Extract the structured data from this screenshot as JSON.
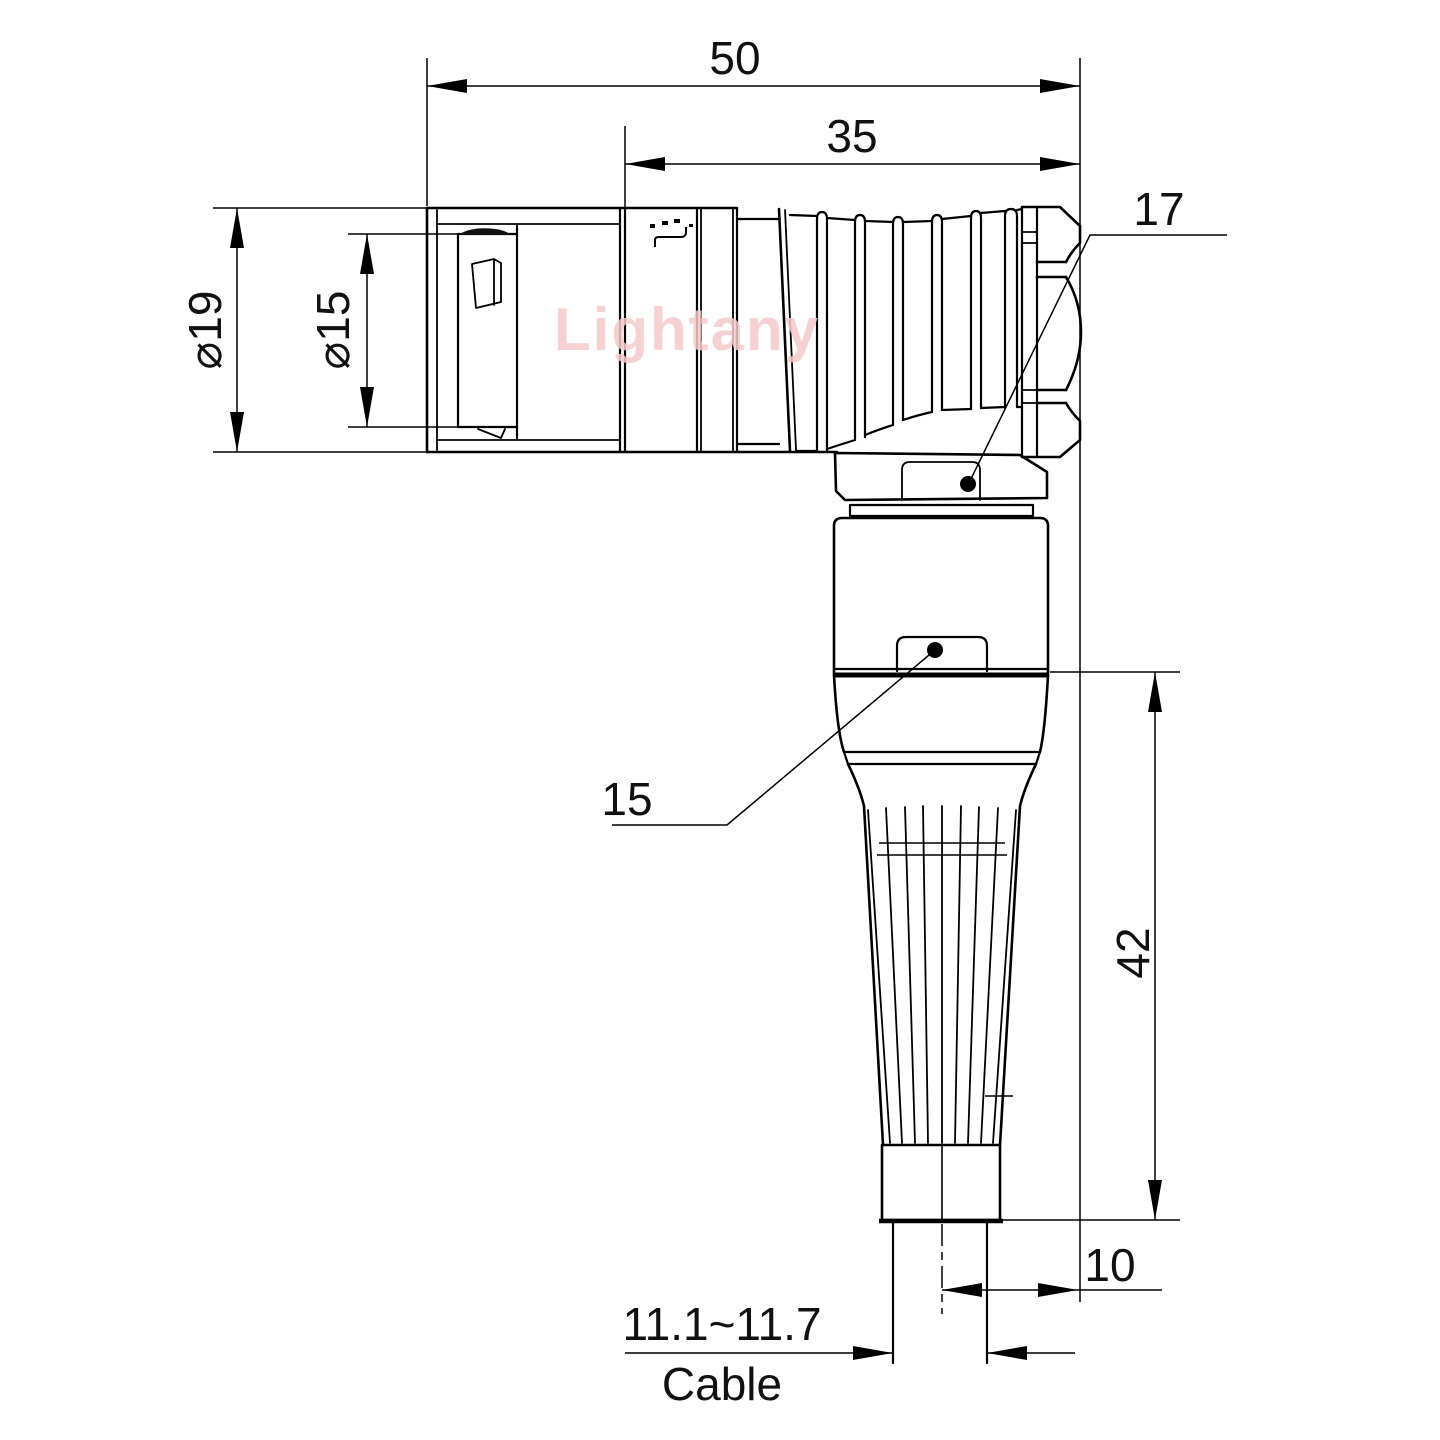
{
  "page": {
    "background": "#ffffff"
  },
  "watermark": {
    "text": "Lightany",
    "color": "#F5CACA"
  },
  "drawing": {
    "type": "technical-drawing",
    "subject": "right-angle circular push-pull connector, side view",
    "dimensions": {
      "overall_length": "50",
      "rear_length": "35",
      "outer_diameter": "⌀19",
      "inner_diameter": "⌀15",
      "vertical_length": "42",
      "axis_to_face": "10",
      "cable_diameter_range": "11.1~11.7",
      "cable_label": "Cable"
    },
    "callouts": {
      "nut_wrench_size": "17",
      "body_wrench_size": "15"
    }
  }
}
